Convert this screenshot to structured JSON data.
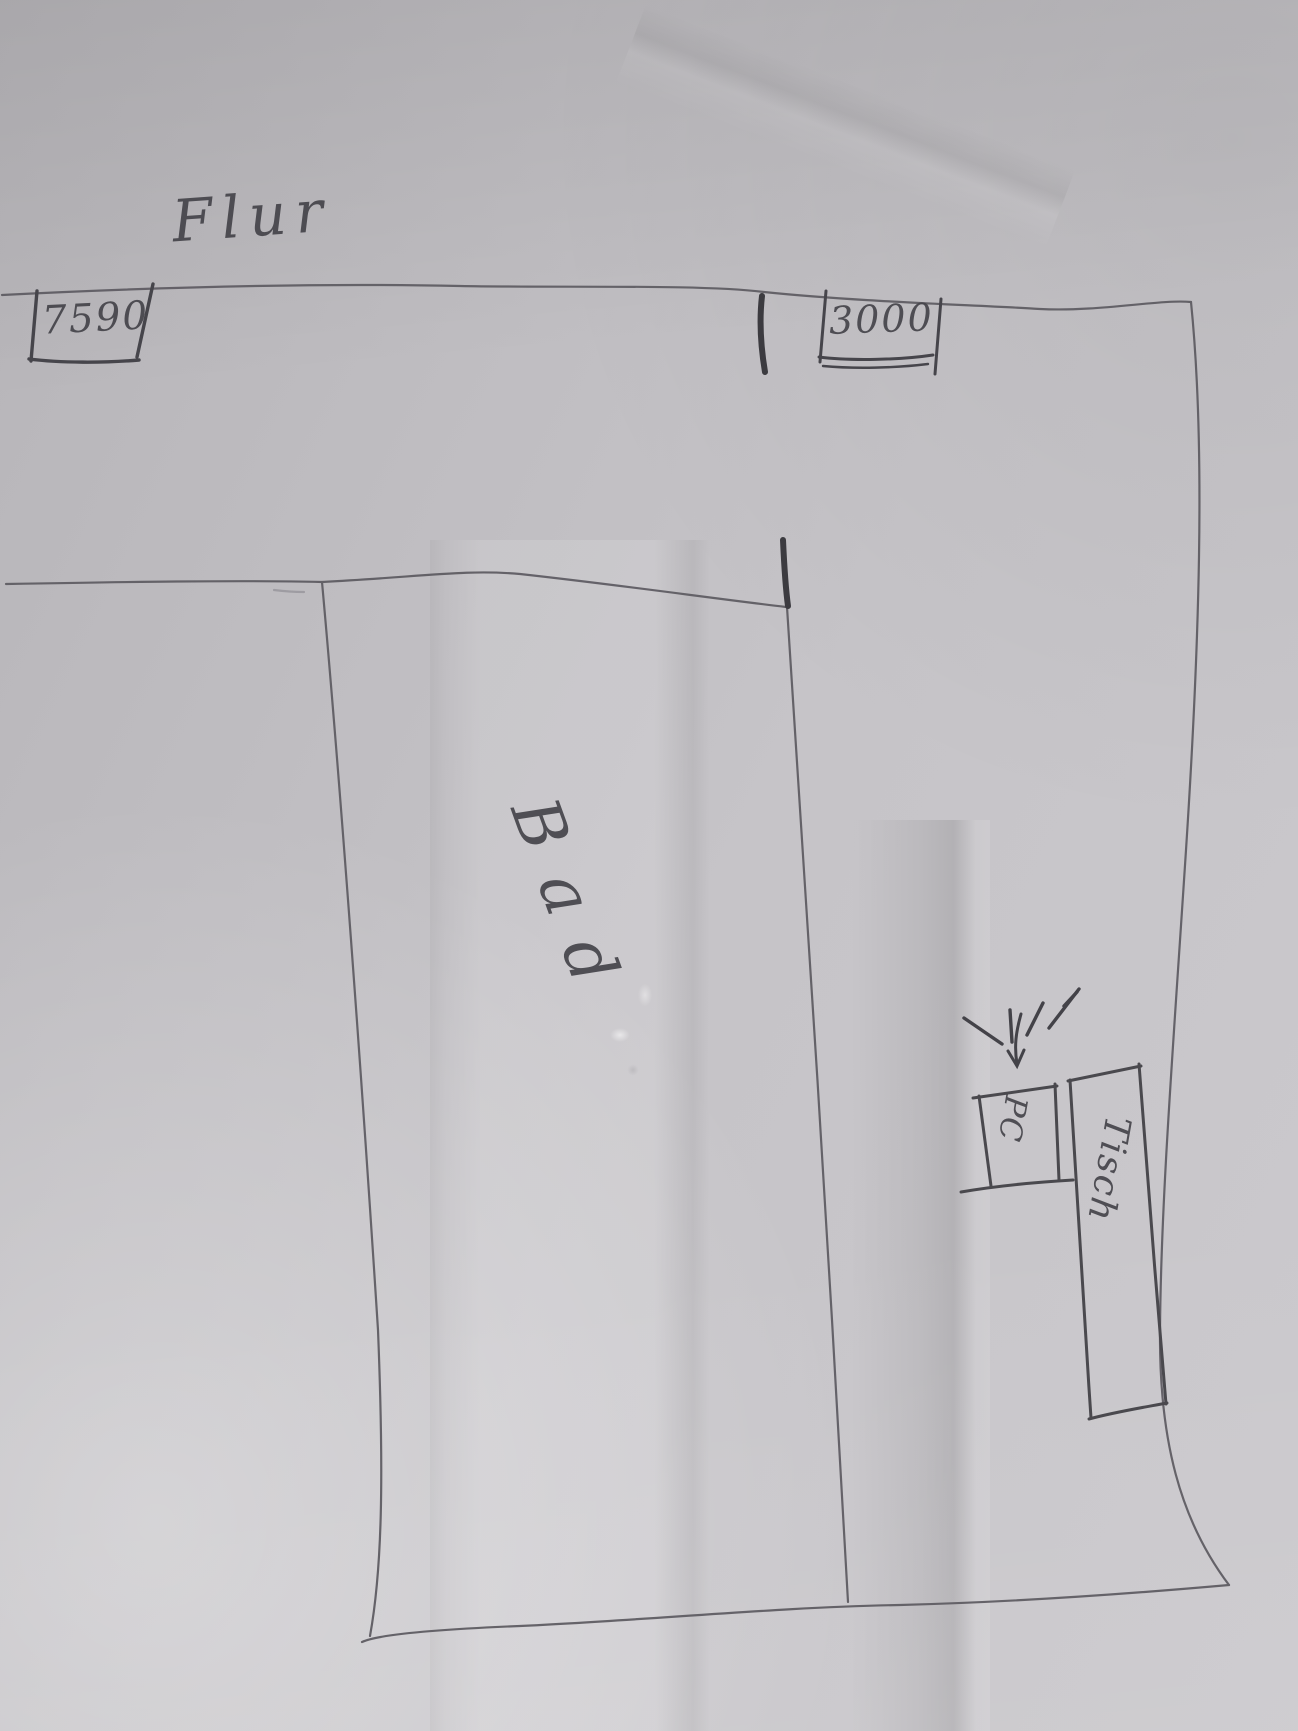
{
  "paper": {
    "base_color": "#c1bfc4",
    "pencil_color": "#5f5d63",
    "dark_pencil_color": "#3c3b40"
  },
  "floorplan": {
    "hallway_label": "Flur",
    "room_label": "Bad",
    "dimensions": {
      "top_left": "7590",
      "top_right": "3000"
    },
    "furniture": {
      "pc_label": "PC",
      "table_label": "Tisch"
    },
    "icons": {
      "pc_callout": "light-rays-arrow-icon"
    }
  }
}
